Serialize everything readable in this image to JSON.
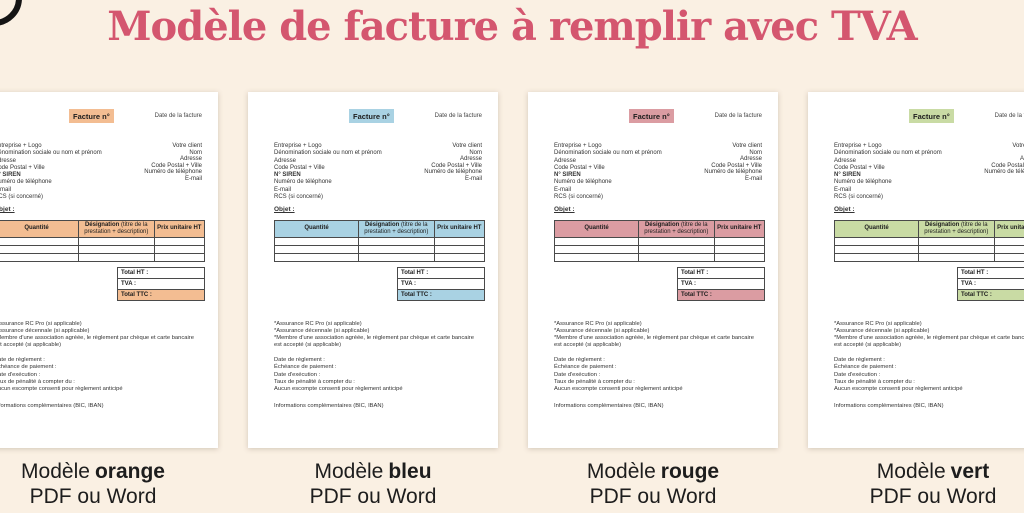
{
  "page": {
    "title": "Modèle de facture à remplir avec TVA",
    "title_color": "#d4566f",
    "background": "#faf0e3"
  },
  "invoice_template": {
    "badge": "Facture n°",
    "date_label": "Date de la facture",
    "sender_lines": [
      "Entreprise + Logo",
      "Dénomination sociale ou nom et prénom",
      "Adresse",
      "Code Postal + Ville",
      "N° SIREN",
      "Numéro de téléphone",
      "E-mail",
      "RCS (si concerné)"
    ],
    "client_lines": [
      "Votre client",
      "Nom",
      "Adresse",
      "Code Postal + Ville",
      "Numéro de téléphone",
      "E-mail"
    ],
    "object_label": "Objet :",
    "table": {
      "headers": [
        "Quantité",
        "Désignation (titre de la prestation + description)",
        "Prix unitaire HT"
      ],
      "col2_bold": "Désignation",
      "col2_rest": "(titre de la prestation + description)",
      "empty_rows": 3
    },
    "totals": [
      "Total HT :",
      "TVA :",
      "Total TTC :"
    ],
    "footnotes": [
      "*Assurance RC Pro (si applicable)",
      "*Assurance décennale (si applicable)",
      "*Membre d'une association agréée, le règlement par chèque et carte bancaire est accepté (si applicable)"
    ],
    "payment_lines": [
      "Date de règlement :",
      "Échéance de paiement :",
      "Date d'exécution :",
      "Taux de pénalité à compter du :",
      "Aucun escompte consenti pour règlement anticipé"
    ],
    "info_line": "Informations complémentaires (BIC, IBAN)"
  },
  "models": [
    {
      "label_prefix": "Modèle",
      "label_bold": "orange",
      "line2": "PDF ou Word",
      "accent": "#f3bd92"
    },
    {
      "label_prefix": "Modèle",
      "label_bold": "bleu",
      "line2": "PDF ou Word",
      "accent": "#a9d2e3"
    },
    {
      "label_prefix": "Modèle",
      "label_bold": "rouge",
      "line2": "PDF ou Word",
      "accent": "#db9ca2"
    },
    {
      "label_prefix": "Modèle",
      "label_bold": "vert",
      "line2": "PDF ou Word",
      "accent": "#c9dba4"
    }
  ]
}
